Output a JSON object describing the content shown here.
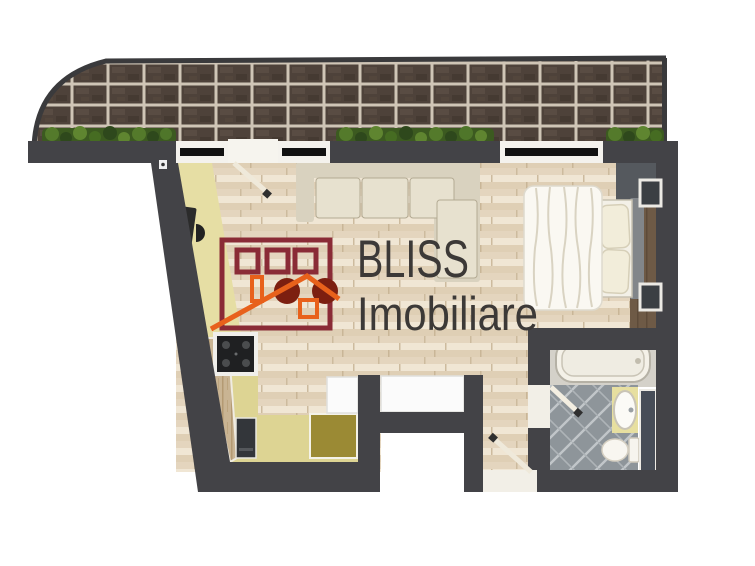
{
  "brand": {
    "name": "BLISS",
    "tagline": "Imobiliare"
  },
  "colors": {
    "wall": "#434347",
    "brick": "#4e423a",
    "brick_grout": "#cfc5b6",
    "plant_green": "#3c5a20",
    "floor_wood": "#eadfcc",
    "kitchen_floor": "#e6dea4",
    "counter_olive": "#9b8a34",
    "tile_gray": "#8e959a",
    "logo_maroon": "#8a2b36",
    "logo_rust": "#7c1f10",
    "logo_orange": "#e8611b",
    "brand_text": "#3c3937"
  }
}
